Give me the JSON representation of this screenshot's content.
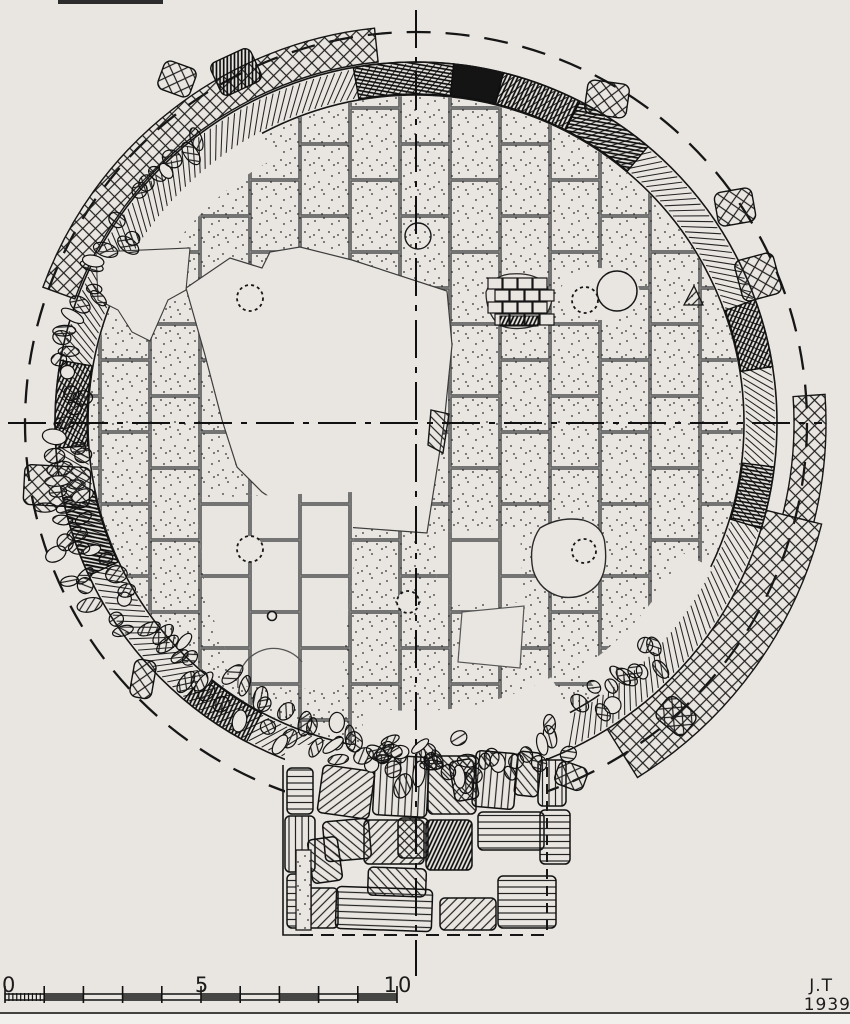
{
  "colors": {
    "paper": "#e9e6e1",
    "paper_below_rule": "#f2f0ec",
    "ink": "#1c1c1c",
    "joint": "#666666"
  },
  "scale_bar": {
    "labels": [
      {
        "text": "0"
      },
      {
        "text": "5"
      },
      {
        "text": "10"
      }
    ]
  },
  "signature": {
    "initials": "J.T",
    "year": "1939"
  }
}
